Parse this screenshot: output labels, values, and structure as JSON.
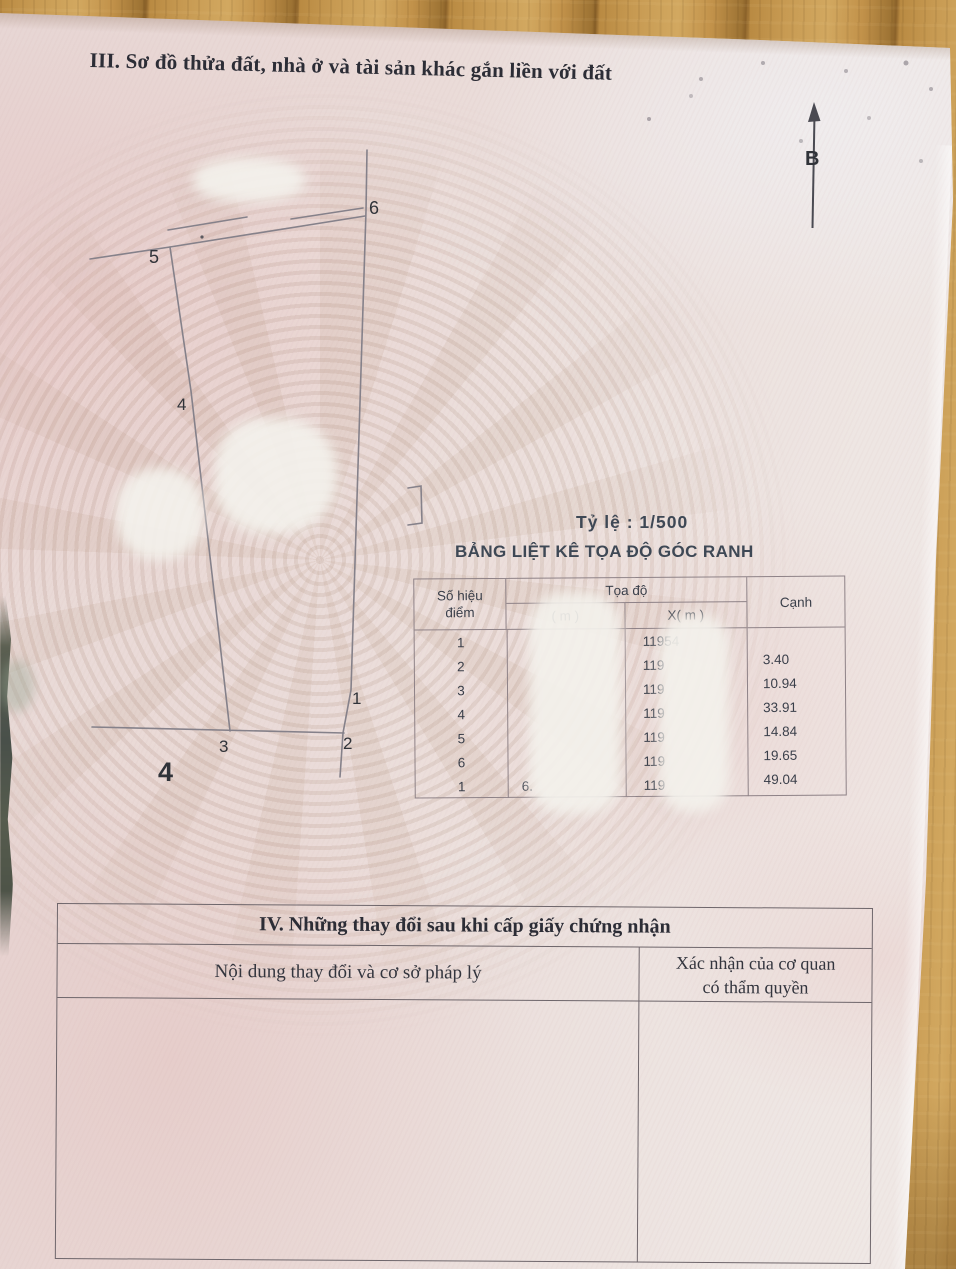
{
  "document": {
    "section3_heading": "III. Sơ đồ thửa đất, nhà ở và tài sản khác gắn liền với đất",
    "scale_label": "Tỷ lệ : 1/500",
    "coord_table_title": "BẢNG LIỆT KÊ TỌA ĐỘ GÓC RANH",
    "north_label": "B"
  },
  "diagram": {
    "point_labels": {
      "p1": "1",
      "p2": "2",
      "p3": "3",
      "p4": "4",
      "p5": "5",
      "p6": "6"
    },
    "adjacent_parcel_label": "4",
    "edge_lengths_m": {
      "1-2": "3.40",
      "2-3": "10.94",
      "3-4": "33.91",
      "4-5": "14.84",
      "5-6": "19.65",
      "6-1": "49.04"
    }
  },
  "coord_table": {
    "header": {
      "point_line1": "Số hiệu",
      "point_line2": "điểm",
      "group": "Tọa độ",
      "y": "( m )",
      "x": "X( m )",
      "edge": "Cạnh"
    },
    "rows": [
      {
        "point": "1",
        "y": "",
        "x": "11954"
      },
      {
        "point": "2",
        "y": "",
        "x": "119"
      },
      {
        "point": "3",
        "y": "",
        "x": "119"
      },
      {
        "point": "4",
        "y": "",
        "x": "119"
      },
      {
        "point": "5",
        "y": "",
        "x": "119"
      },
      {
        "point": "6",
        "y": "",
        "x": "119"
      },
      {
        "point": "1",
        "y": "6.",
        "x": "119"
      }
    ],
    "edges": [
      "3.40",
      "10.94",
      "33.91",
      "14.84",
      "19.65",
      "49.04"
    ]
  },
  "section4": {
    "title": "IV. Những thay đổi sau khi cấp giấy chứng nhận",
    "col_content": "Nội dung thay đổi và cơ sở pháp lý",
    "col_confirm_line1": "Xác nhận của cơ quan",
    "col_confirm_line2": "có thẩm quyền"
  }
}
